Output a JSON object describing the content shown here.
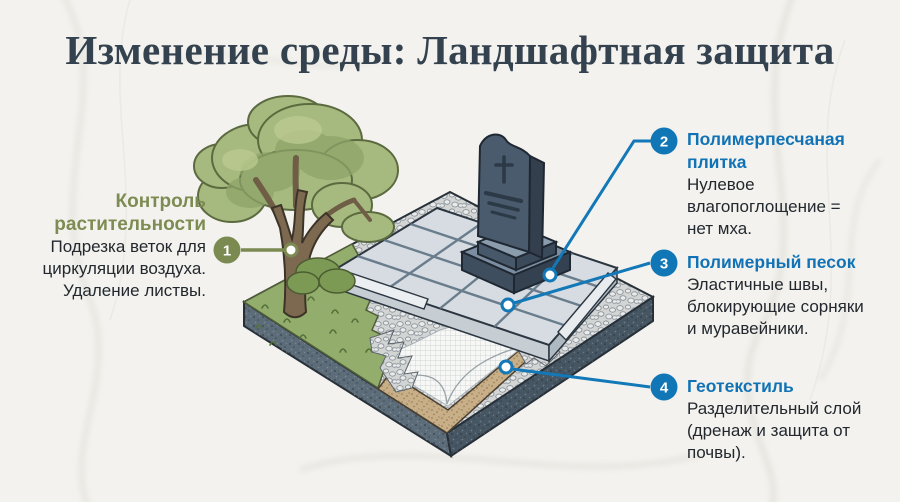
{
  "title": "Изменение среды: Ландшафтная защита",
  "colors": {
    "accent_green": "#7b8a50",
    "accent_blue": "#1278b7",
    "body_text": "#22282e",
    "title_text": "#33424e",
    "background": "#f3f2ee"
  },
  "callout_1": {
    "number": "1",
    "heading_lines": [
      "Контроль",
      "растительности"
    ],
    "body_lines": [
      "Подрезка веток для",
      "циркуляции воздуха.",
      "Удаление листвы."
    ]
  },
  "callout_2": {
    "number": "2",
    "heading_lines": [
      "Полимерпесчаная",
      "плитка"
    ],
    "body_lines": [
      "Нулевое",
      "влагопоглощение =",
      "нет мха."
    ]
  },
  "callout_3": {
    "number": "3",
    "heading_lines": [
      "Полимерный песок"
    ],
    "body_lines": [
      "Эластичные швы,",
      "блокирующие сорняки",
      "и муравейники."
    ]
  },
  "callout_4": {
    "number": "4",
    "heading_lines": [
      "Геотекстиль"
    ],
    "body_lines": [
      "Разделительный слой",
      "(дренаж и защита от",
      "почвы)."
    ]
  },
  "scene_items": [
    "tree",
    "grass",
    "gravel",
    "paving-tiles",
    "curb",
    "tombstone",
    "geotextile",
    "sand-layer",
    "soil-block"
  ]
}
